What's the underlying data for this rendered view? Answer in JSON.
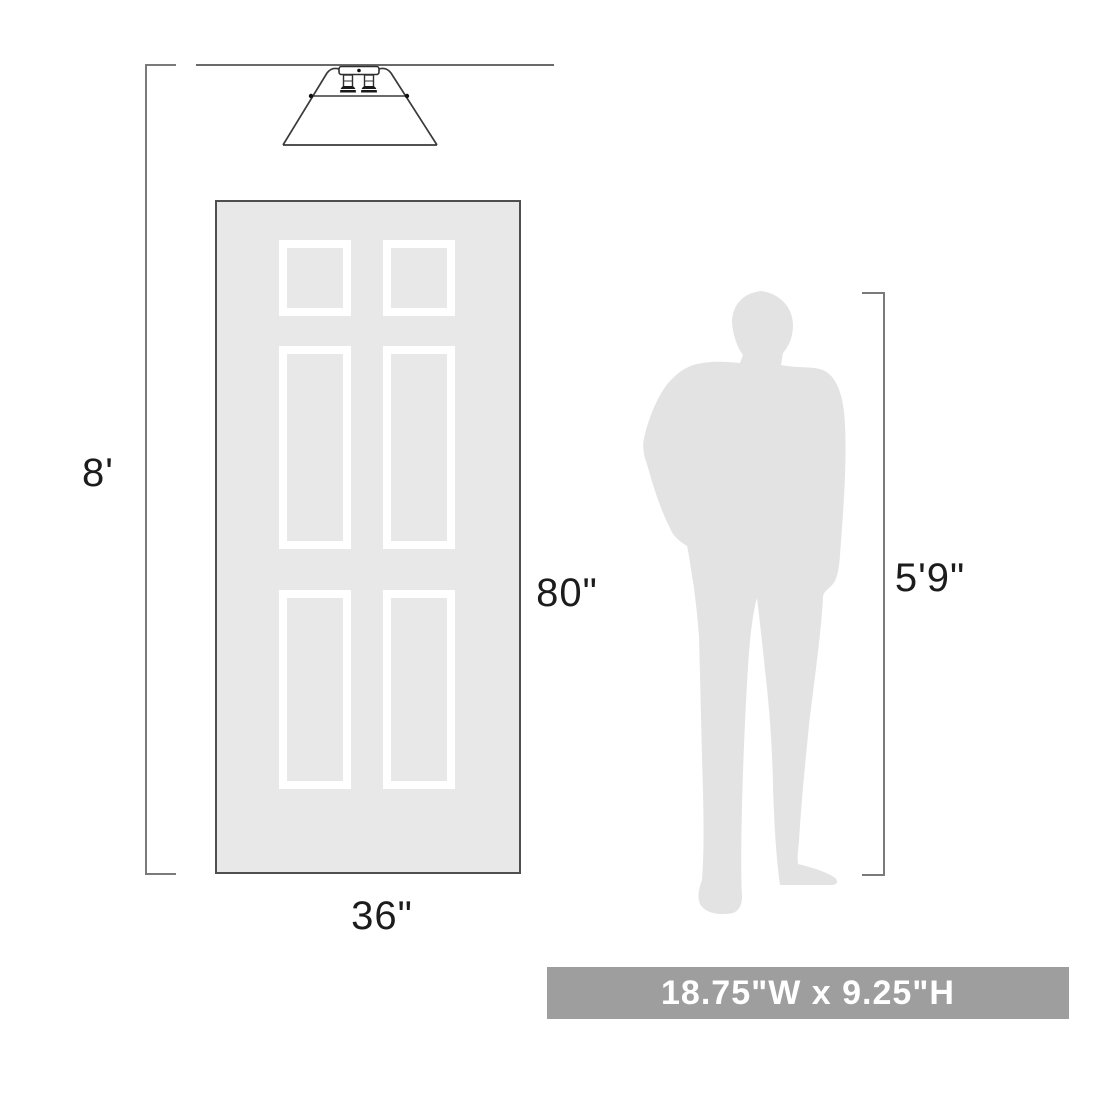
{
  "diagram": {
    "title": "lighting-product-scale-diagram",
    "ceiling_height_label": "8'",
    "door_height_label": "80\"",
    "door_width_label": "36\"",
    "person_height_label": "5'9\"",
    "size_banner_label": "18.75\"W x 9.25\"H",
    "reference_objects": [
      "flush-mount-ceiling-light",
      "six-panel-door",
      "man-silhouette"
    ],
    "colors": {
      "background": "#ffffff",
      "door_fill": "#e8e8e8",
      "door_border": "#4f4f4f",
      "panel_frame": "#ffffff",
      "silhouette_fill": "#e3e3e3",
      "dimension_line": "#7a7a7a",
      "label_text": "#1c1c1c",
      "banner_background": "#9e9e9e",
      "banner_text": "#ffffff"
    }
  }
}
